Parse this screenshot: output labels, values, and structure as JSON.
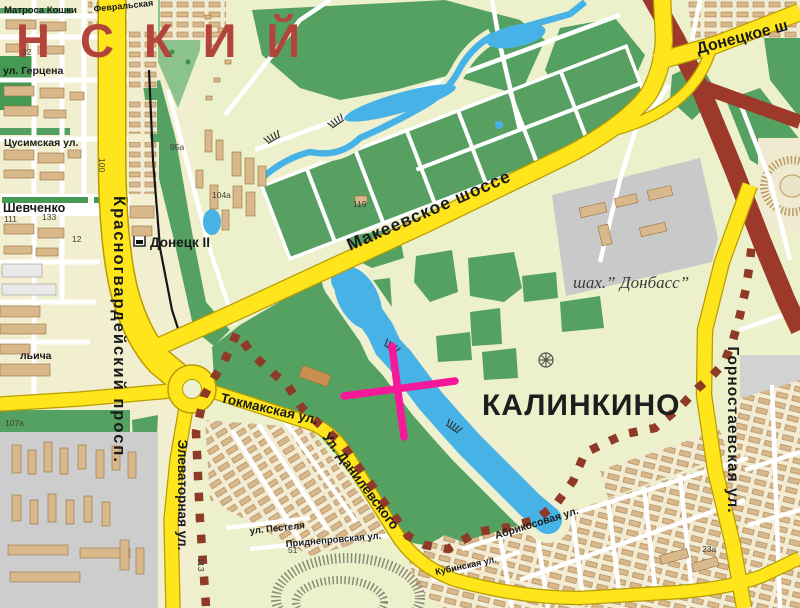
{
  "region": {
    "district_name_partial": "НСКИЙ",
    "settlement": "КАЛИНКИНО",
    "mine_label": "шах.” Донбасс”",
    "station_label": "Донецк II"
  },
  "roads": {
    "makeevskoe_shosse": "Макеевское шоссе",
    "donetskoe_shosse_partial": "Донецкое ш",
    "krasnogvardeysky_prospekt": "Красногвардейский просп.",
    "elevatornaya": "Элеваторная ул.",
    "tokmakskaya": "Токмакская ул.",
    "danilevskogo": "Ул. Данилевского",
    "gornostaevskaya": "Горностаевская ул.",
    "abrikosovaya": "Абрикосовая ул.",
    "kubinskaya": "Кубинская ул.",
    "pestelya": "ул. Пестеля",
    "pridneprovskaya": "Приднепровская ул.",
    "gertsena": "ул. Герцена",
    "tsusimskaya": "Цусимская ул.",
    "shevchenko": "Шевченко",
    "matrosa_koshki": "Матроса Кошки",
    "fevralskaya": "Февральская",
    "ilyicha_partial": "льича"
  },
  "building_numbers": {
    "n32": "32",
    "n100": "100",
    "n111": "111",
    "n133": "133",
    "n12": "12",
    "n95a": "95а",
    "n104a": "104а",
    "n119": "119",
    "n107a": "107а",
    "n113": "113",
    "n51": "51",
    "n23a": "23а"
  },
  "marker": {
    "type": "x-cross",
    "color": "#F6189B"
  },
  "legend_colors": {
    "major_road": "#FFE51C",
    "highway": "#9C392B",
    "water": "#47B2E6",
    "park": "#55A161",
    "building": "#D9B88C",
    "boundary_dash": "#8E3A26",
    "district_text": "#B2443C"
  }
}
